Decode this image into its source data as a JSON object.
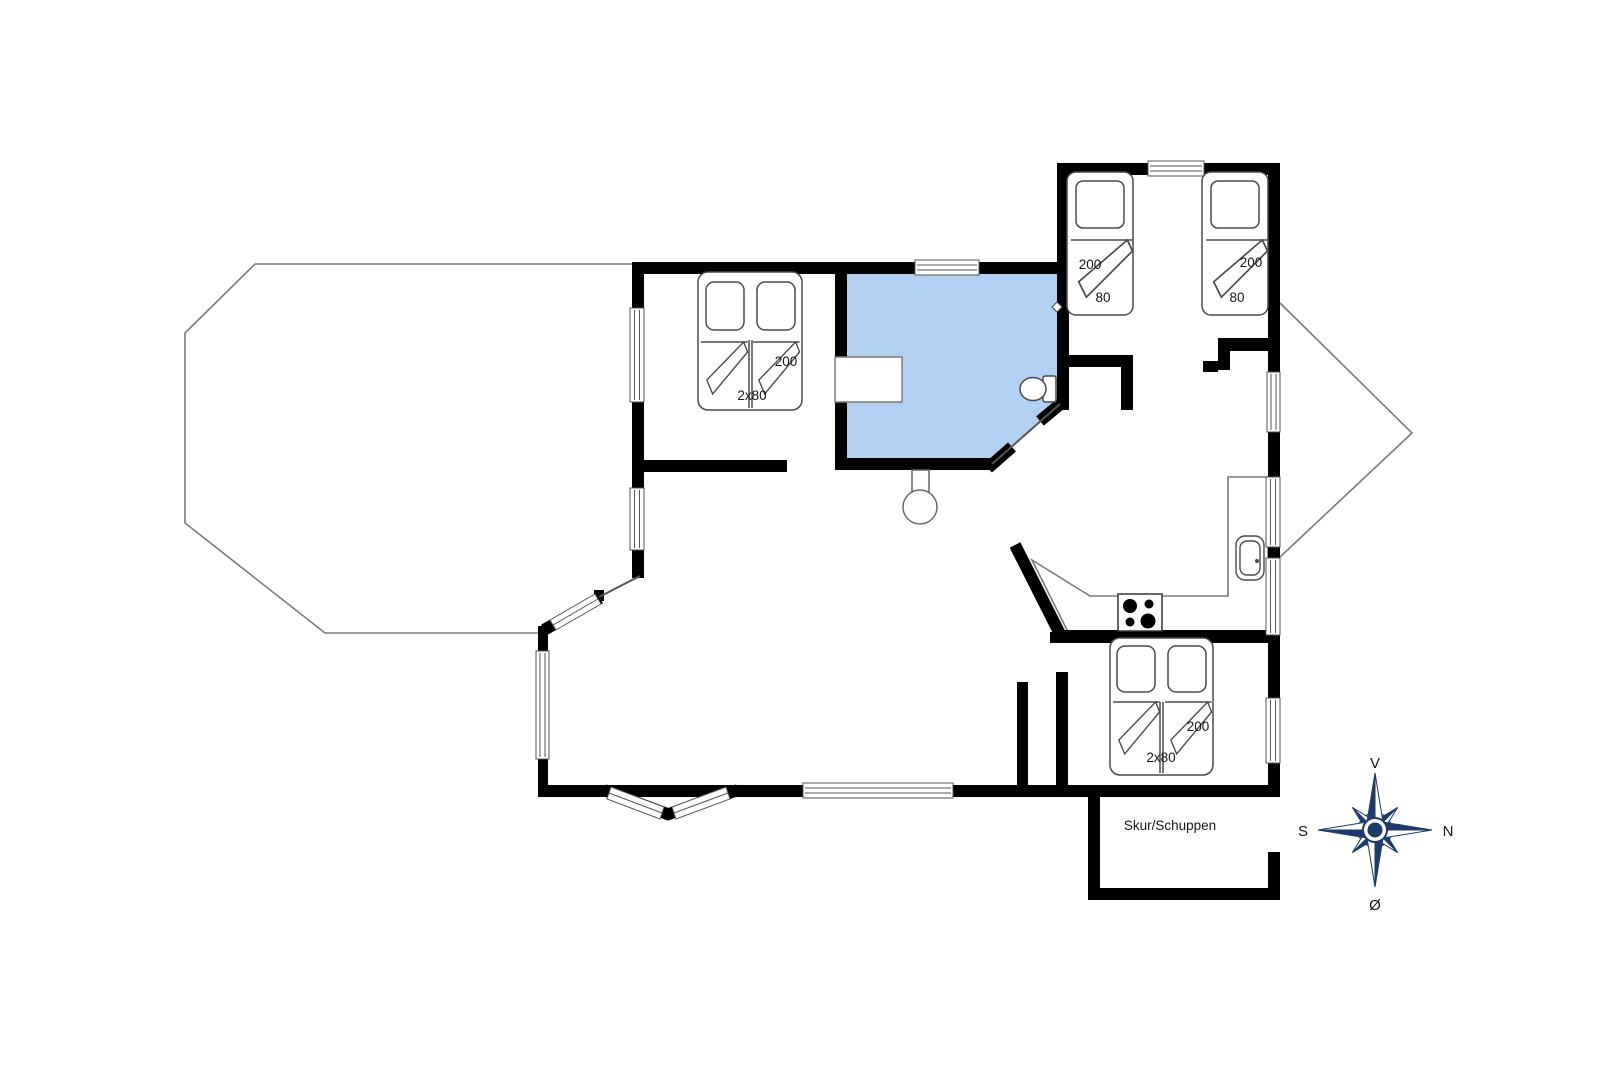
{
  "plan": {
    "shed": {
      "label": "Skur/Schuppen"
    },
    "beds": {
      "double_top_left": {
        "length": "200",
        "width": "2x80"
      },
      "single_left": {
        "length": "200",
        "width": "80"
      },
      "single_right": {
        "length": "200",
        "width": "80"
      },
      "double_bottom_right": {
        "length": "200",
        "width": "2x80"
      }
    },
    "compass": {
      "top": "V",
      "right": "N",
      "left": "S",
      "bottom": "Ø"
    },
    "colors": {
      "wall": "#000000",
      "bathroom_fill": "#b3d0f2",
      "thin_outline": "#7a7a7a",
      "fixture_outline": "#4a4a4a",
      "compass_navy": "#1d3a6d"
    }
  }
}
